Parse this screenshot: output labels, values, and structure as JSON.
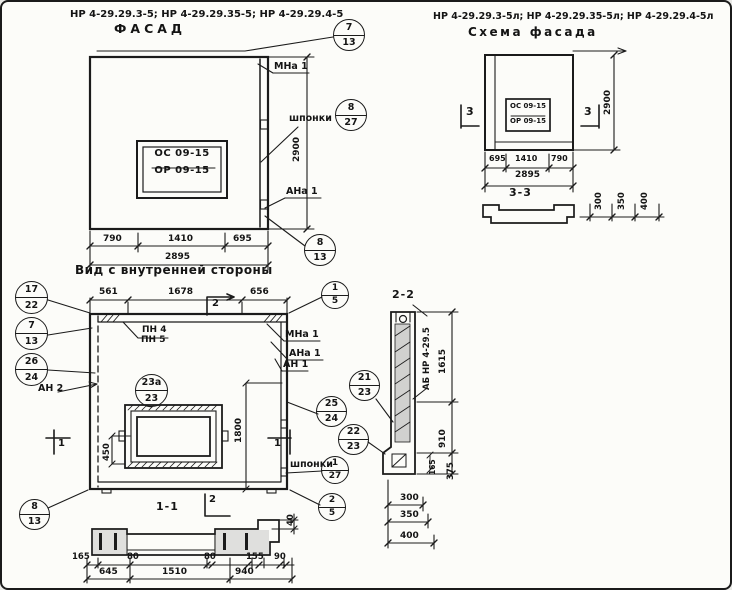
{
  "facade": {
    "code_title": "НР 4-29.29.3-5; НР 4-29.29.35-5; НР 4-29.29.4-5",
    "title": "ФАСАД",
    "plaque_line1": "ОС 09-15",
    "plaque_line2": "ОР 09-15",
    "label_mna1": "МНа 1",
    "label_shponki": "шпонки",
    "label_ana1": "АНа 1",
    "callout_top": {
      "pos": "7",
      "sheet": "13"
    },
    "callout_shponki": {
      "pos": "8",
      "sheet": "27"
    },
    "callout_bottom": {
      "pos": "8",
      "sheet": "13"
    },
    "dims": {
      "w1": "790",
      "w2": "1410",
      "w3": "695",
      "total": "2895",
      "height": "2900"
    }
  },
  "scheme": {
    "code_title": "НР 4-29.29.3-5л; НР 4-29.29.35-5л; НР 4-29.29.4-5л",
    "title": "Схема фасада",
    "plaque_line1": "ОС 09-15",
    "plaque_line2": "ОР 09-15",
    "marker_left": "3",
    "marker_right": "3",
    "dims": {
      "w1": "695",
      "w2": "1410",
      "w3": "790",
      "total": "2895",
      "height": "2900"
    }
  },
  "section33": {
    "title": "3-3",
    "dims": [
      "300",
      "350",
      "400"
    ]
  },
  "inner": {
    "title": "Вид с внутренней стороны",
    "dims_top": [
      "561",
      "1678",
      "656"
    ],
    "marker_top": "2",
    "marker_left": "1",
    "marker_right": "1",
    "callout_15": {
      "pos": "1",
      "sheet": "5"
    },
    "callouts_left": [
      {
        "pos": "17",
        "sheet": "22"
      },
      {
        "pos": "7",
        "sheet": "13"
      },
      {
        "pos": "26",
        "sheet": "24"
      }
    ],
    "label_an2": "АН 2",
    "label_pn4": "ПН 4",
    "label_pn5": "ПН 5",
    "label_mna1": "МНа 1",
    "label_ana1": "АНа 1",
    "label_an1": "АН 1",
    "callout_2123": {
      "pos": "21",
      "sheet": "23"
    },
    "callout_23a": {
      "pos": "23а",
      "sheet": "23"
    },
    "callout_2524": {
      "pos": "25",
      "sheet": "24"
    },
    "callout_2223": {
      "pos": "22",
      "sheet": "23"
    },
    "label_shponki": "шпонки",
    "callout_shponki": {
      "pos": "1",
      "sheet": "27"
    },
    "callout_25": {
      "pos": "2",
      "sheet": "5"
    },
    "callout_813": {
      "pos": "8",
      "sheet": "13"
    },
    "dim_1800": "1800",
    "dim_450": "450"
  },
  "section11": {
    "title": "1-1",
    "marker": "2",
    "dim_40": "40",
    "dims_top": [
      "165",
      "80",
      "80",
      "155",
      "90"
    ],
    "dims_bottom": [
      "645",
      "1510",
      "940"
    ]
  },
  "section22": {
    "title": "2-2",
    "part_label": "АБ НР 4-29.5",
    "dim_1615": "1615",
    "dim_910": "910",
    "dim_375": "375",
    "dim_165": "165",
    "dims_bottom": [
      "300",
      "350",
      "400"
    ]
  }
}
